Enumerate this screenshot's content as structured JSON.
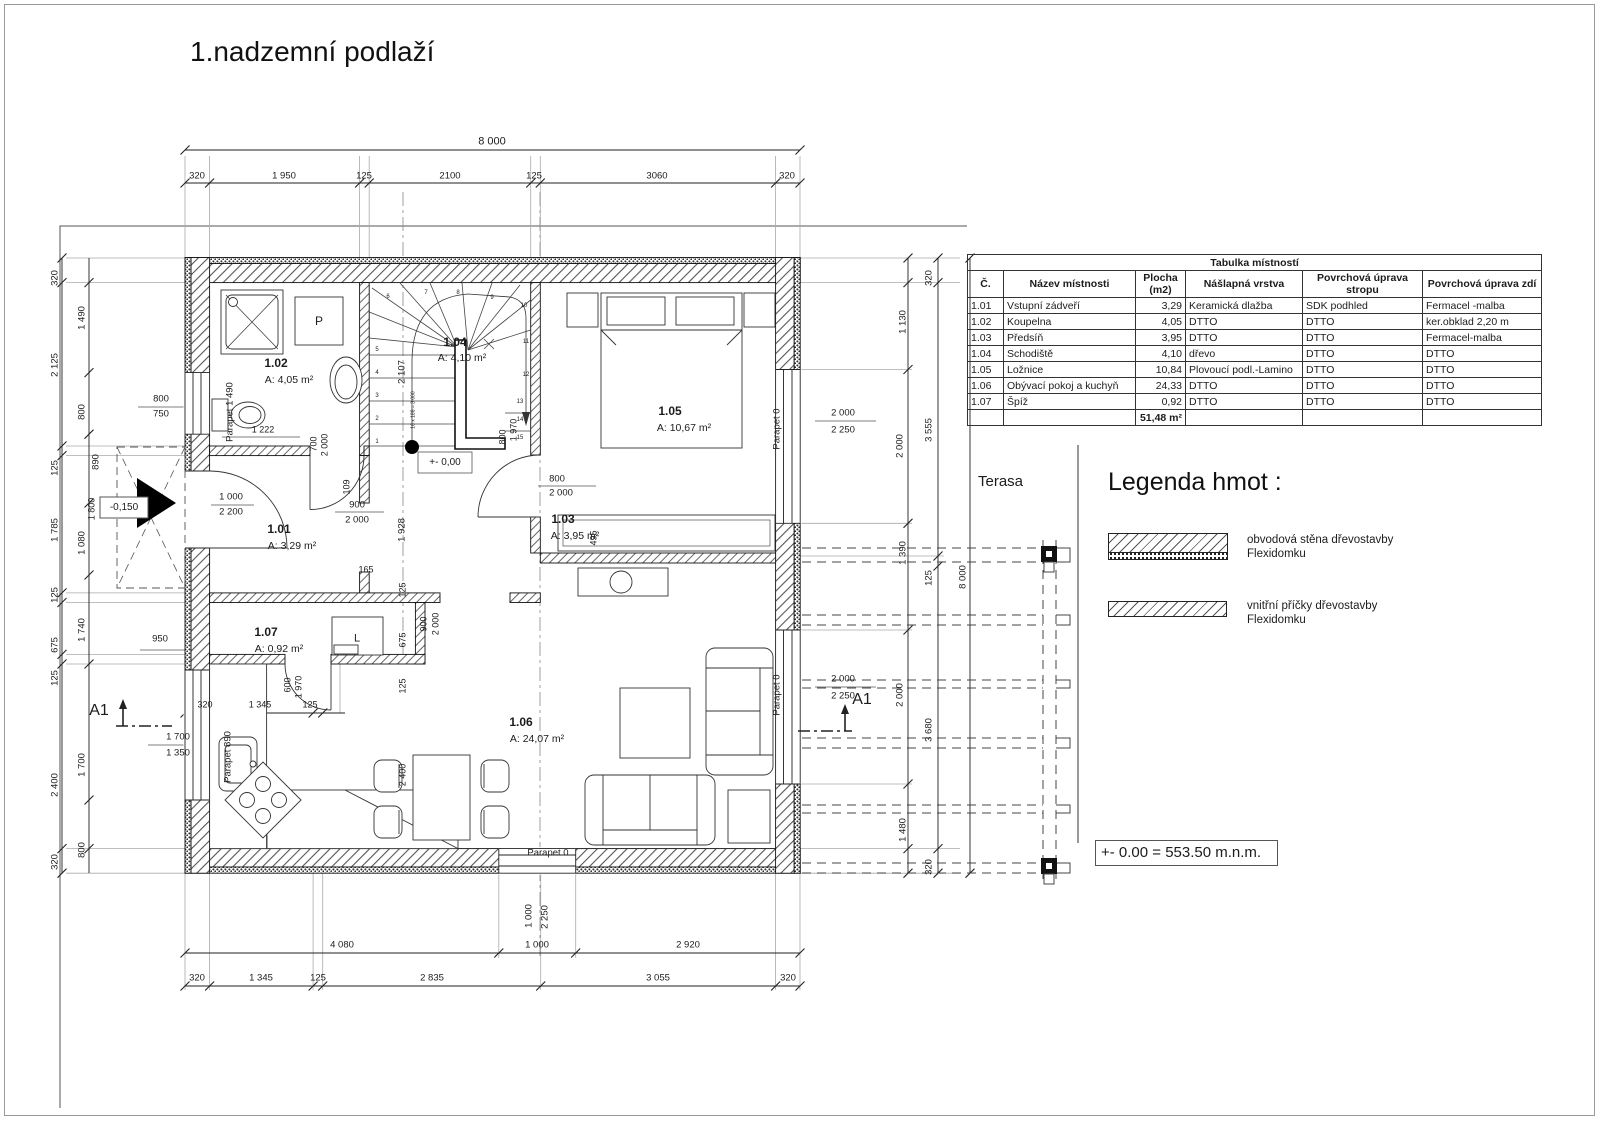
{
  "title": "1.nadzemní podlaží",
  "terrace_label": "Terasa",
  "elevation_note": "+- 0.00 = 553.50 m.n.m.",
  "legend": {
    "title": "Legenda hmot :",
    "items": [
      {
        "swatch": "exterior-wall-hatch",
        "label_line1": "obvodová stěna dřevostavby",
        "label_line2": "Flexidomku"
      },
      {
        "swatch": "interior-partition-hatch",
        "label_line1": "vnitřní příčky dřevostavby",
        "label_line2": "Flexidomku"
      }
    ]
  },
  "room_table": {
    "title": "Tabulka místností",
    "headers": [
      "Č.",
      "Název místnosti",
      "Plocha (m2)",
      "Nášlapná vrstva",
      "Povrchová úprava stropu",
      "Povrchová úprava zdí"
    ],
    "rows": [
      [
        "1.01",
        "Vstupní zádveří",
        "3,29",
        "Keramická dlažba",
        "SDK podhled",
        "Fermacel -malba"
      ],
      [
        "1.02",
        "Koupelna",
        "4,05",
        "DTTO",
        "DTTO",
        "ker.obklad 2,20 m"
      ],
      [
        "1.03",
        "Předsíň",
        "3,95",
        "DTTO",
        "DTTO",
        "Fermacel-malba"
      ],
      [
        "1.04",
        "Schodiště",
        "4,10",
        "dřevo",
        "DTTO",
        "DTTO"
      ],
      [
        "1.05",
        "Ložnice",
        "10,84",
        "Plovoucí podl.-Lamino",
        "DTTO",
        "DTTO"
      ],
      [
        "1.06",
        "Obývací pokoj  a kuchyň",
        "24,33",
        "DTTO",
        "DTTO",
        "DTTO"
      ],
      [
        "1.07",
        "Špíž",
        "0,92",
        "DTTO",
        "DTTO",
        "DTTO"
      ]
    ],
    "total": "51,48 m²"
  },
  "labels": [
    {
      "t": "8 000",
      "x": 492,
      "y": 142,
      "s": 11
    },
    {
      "t": "320",
      "x": 197,
      "y": 176
    },
    {
      "t": "1 950",
      "x": 284,
      "y": 176
    },
    {
      "t": "125",
      "x": 364,
      "y": 176
    },
    {
      "t": "2100",
      "x": 450,
      "y": 176
    },
    {
      "t": "125",
      "x": 534,
      "y": 176
    },
    {
      "t": "3060",
      "x": 657,
      "y": 176
    },
    {
      "t": "320",
      "x": 787,
      "y": 176
    },
    {
      "t": "320",
      "x": 55,
      "y": 278,
      "r": -90
    },
    {
      "t": "2 125",
      "x": 55,
      "y": 365,
      "r": -90
    },
    {
      "t": "125",
      "x": 55,
      "y": 468,
      "r": -90
    },
    {
      "t": "1 785",
      "x": 55,
      "y": 530,
      "r": -90
    },
    {
      "t": "125",
      "x": 55,
      "y": 595,
      "r": -90
    },
    {
      "t": "675",
      "x": 55,
      "y": 645,
      "r": -90
    },
    {
      "t": "125",
      "x": 55,
      "y": 678,
      "r": -90
    },
    {
      "t": "2 400",
      "x": 55,
      "y": 785,
      "r": -90
    },
    {
      "t": "320",
      "x": 55,
      "y": 862,
      "r": -90
    },
    {
      "t": "1 490",
      "x": 82,
      "y": 318,
      "r": -90
    },
    {
      "t": "800",
      "x": 82,
      "y": 412,
      "r": -90
    },
    {
      "t": "890",
      "x": 96,
      "y": 462,
      "r": -90
    },
    {
      "t": "1 080",
      "x": 82,
      "y": 543,
      "r": -90
    },
    {
      "t": "1 740",
      "x": 82,
      "y": 630,
      "r": -90
    },
    {
      "t": "1 700",
      "x": 82,
      "y": 765,
      "r": -90
    },
    {
      "t": "800",
      "x": 82,
      "y": 850,
      "r": -90
    },
    {
      "t": "800",
      "x": 161,
      "y": 399
    },
    {
      "t": "750",
      "x": 161,
      "y": 414
    },
    {
      "t": "950",
      "x": 160,
      "y": 639
    },
    {
      "t": "-0,150",
      "x": 124,
      "y": 508,
      "s": 10
    },
    {
      "t": "1 800",
      "x": 92,
      "y": 509,
      "r": -90,
      "s": 9
    },
    {
      "t": "1 700",
      "x": 178,
      "y": 737
    },
    {
      "t": "1 350",
      "x": 178,
      "y": 753
    },
    {
      "t": "A1",
      "x": 99,
      "y": 711,
      "s": 16
    },
    {
      "t": "A1",
      "x": 862,
      "y": 700,
      "s": 16
    },
    {
      "t": "1 000",
      "x": 231,
      "y": 497
    },
    {
      "t": "2 200",
      "x": 231,
      "y": 512
    },
    {
      "t": "Parapet 1 490",
      "x": 230,
      "y": 412,
      "r": -90
    },
    {
      "t": "1.02",
      "x": 276,
      "y": 363,
      "b": 1,
      "s": 12
    },
    {
      "t": "A: 4,05 m²",
      "x": 289,
      "y": 380,
      "s": 10.5
    },
    {
      "t": "P",
      "x": 319,
      "y": 321,
      "s": 12
    },
    {
      "t": "1 222",
      "x": 263,
      "y": 430,
      "s": 9
    },
    {
      "t": "700",
      "x": 314,
      "y": 444,
      "r": -90,
      "s": 9
    },
    {
      "t": "2 000",
      "x": 325,
      "y": 445,
      "r": -90,
      "s": 9
    },
    {
      "t": "109",
      "x": 347,
      "y": 487,
      "r": -90,
      "s": 9
    },
    {
      "t": "1.01",
      "x": 279,
      "y": 529,
      "b": 1,
      "s": 12
    },
    {
      "t": "A: 3,29 m²",
      "x": 292,
      "y": 546,
      "s": 10.5
    },
    {
      "t": "900",
      "x": 357,
      "y": 505
    },
    {
      "t": "2 000",
      "x": 357,
      "y": 520
    },
    {
      "t": "1.04",
      "x": 455,
      "y": 342,
      "b": 1,
      "s": 12
    },
    {
      "t": "A: 4,10 m²",
      "x": 462,
      "y": 358,
      "s": 10.5
    },
    {
      "t": "2 107",
      "x": 402,
      "y": 372,
      "r": -90
    },
    {
      "t": "1 928",
      "x": 402,
      "y": 530,
      "r": -90
    },
    {
      "t": "16 x 188 = 3 000",
      "x": 414,
      "y": 410,
      "r": -90,
      "s": 5
    },
    {
      "t": "+- 0,00",
      "x": 445,
      "y": 463,
      "s": 10
    },
    {
      "t": "1",
      "x": 377,
      "y": 442,
      "s": 6
    },
    {
      "t": "2",
      "x": 377,
      "y": 419,
      "s": 6
    },
    {
      "t": "3",
      "x": 377,
      "y": 396,
      "s": 6
    },
    {
      "t": "4",
      "x": 377,
      "y": 373,
      "s": 6
    },
    {
      "t": "5",
      "x": 377,
      "y": 350,
      "s": 6
    },
    {
      "t": "6",
      "x": 388,
      "y": 297,
      "s": 6
    },
    {
      "t": "7",
      "x": 426,
      "y": 293,
      "s": 6
    },
    {
      "t": "8",
      "x": 458,
      "y": 293,
      "s": 6
    },
    {
      "t": "9",
      "x": 492,
      "y": 298,
      "s": 6
    },
    {
      "t": "10",
      "x": 524,
      "y": 306,
      "s": 6
    },
    {
      "t": "11",
      "x": 526,
      "y": 342,
      "s": 6
    },
    {
      "t": "12",
      "x": 526,
      "y": 375,
      "s": 6
    },
    {
      "t": "13",
      "x": 520,
      "y": 402,
      "s": 6
    },
    {
      "t": "14",
      "x": 520,
      "y": 420,
      "s": 6
    },
    {
      "t": "15",
      "x": 520,
      "y": 438,
      "s": 6
    },
    {
      "t": "800",
      "x": 503,
      "y": 437,
      "r": -90,
      "s": 9
    },
    {
      "t": "1 970",
      "x": 514,
      "y": 430,
      "r": -90,
      "s": 9
    },
    {
      "t": "1.03",
      "x": 563,
      "y": 519,
      "b": 1,
      "s": 12
    },
    {
      "t": "A: 3,95 m²",
      "x": 575,
      "y": 536,
      "s": 10.5
    },
    {
      "t": "800",
      "x": 557,
      "y": 479
    },
    {
      "t": "2 000",
      "x": 561,
      "y": 493
    },
    {
      "t": "1.05",
      "x": 670,
      "y": 411,
      "b": 1,
      "s": 12
    },
    {
      "t": "A: 10,67 m²",
      "x": 684,
      "y": 428,
      "s": 10.5
    },
    {
      "t": "Parapet 0",
      "x": 777,
      "y": 429,
      "r": -90
    },
    {
      "t": "495",
      "x": 594,
      "y": 538,
      "r": -90,
      "s": 9
    },
    {
      "t": "1.07",
      "x": 266,
      "y": 632,
      "b": 1,
      "s": 12
    },
    {
      "t": "A: 0,92 m²",
      "x": 279,
      "y": 649,
      "s": 10.5
    },
    {
      "t": "L",
      "x": 357,
      "y": 639,
      "s": 11
    },
    {
      "t": "165",
      "x": 366,
      "y": 570,
      "s": 9
    },
    {
      "t": "125",
      "x": 403,
      "y": 590,
      "r": -90,
      "s": 9
    },
    {
      "t": "675",
      "x": 403,
      "y": 640,
      "r": -90,
      "s": 9
    },
    {
      "t": "125",
      "x": 403,
      "y": 686,
      "r": -90,
      "s": 9
    },
    {
      "t": "900",
      "x": 424,
      "y": 624,
      "r": -90,
      "s": 9
    },
    {
      "t": "2 000",
      "x": 436,
      "y": 624,
      "r": -90,
      "s": 9
    },
    {
      "t": "600",
      "x": 288,
      "y": 685,
      "r": -90,
      "s": 9
    },
    {
      "t": "1 970",
      "x": 299,
      "y": 687,
      "r": -90,
      "s": 9
    },
    {
      "t": "320",
      "x": 205,
      "y": 705,
      "s": 9
    },
    {
      "t": "1 345",
      "x": 260,
      "y": 705,
      "s": 9
    },
    {
      "t": "125",
      "x": 310,
      "y": 705,
      "s": 9
    },
    {
      "t": "Parapet 890",
      "x": 228,
      "y": 757,
      "r": -90
    },
    {
      "t": "2 400",
      "x": 403,
      "y": 775,
      "r": -90,
      "s": 9
    },
    {
      "t": "1.06",
      "x": 521,
      "y": 722,
      "b": 1,
      "s": 12
    },
    {
      "t": "A: 24,07 m²",
      "x": 537,
      "y": 739,
      "s": 10.5
    },
    {
      "t": "Parapet 0",
      "x": 548,
      "y": 853
    },
    {
      "t": "Parapet 0",
      "x": 777,
      "y": 695,
      "r": -90
    },
    {
      "t": "2 000",
      "x": 843,
      "y": 413
    },
    {
      "t": "2 250",
      "x": 843,
      "y": 430
    },
    {
      "t": "2 000",
      "x": 843,
      "y": 679
    },
    {
      "t": "2 250",
      "x": 843,
      "y": 696
    },
    {
      "t": "320",
      "x": 929,
      "y": 278,
      "r": -90
    },
    {
      "t": "1 130",
      "x": 903,
      "y": 322,
      "r": -90
    },
    {
      "t": "2 000",
      "x": 900,
      "y": 446,
      "r": -90
    },
    {
      "t": "3 555",
      "x": 929,
      "y": 430,
      "r": -90
    },
    {
      "t": "1 390",
      "x": 903,
      "y": 553,
      "r": -90
    },
    {
      "t": "125",
      "x": 929,
      "y": 578,
      "r": -90
    },
    {
      "t": "2 000",
      "x": 900,
      "y": 695,
      "r": -90
    },
    {
      "t": "3 680",
      "x": 929,
      "y": 730,
      "r": -90
    },
    {
      "t": "1 480",
      "x": 903,
      "y": 830,
      "r": -90
    },
    {
      "t": "320",
      "x": 929,
      "y": 867,
      "r": -90
    },
    {
      "t": "8 000",
      "x": 963,
      "y": 577,
      "r": -90
    },
    {
      "t": "1 000",
      "x": 529,
      "y": 916,
      "r": -90
    },
    {
      "t": "2 250",
      "x": 545,
      "y": 917,
      "r": -90
    },
    {
      "t": "4 080",
      "x": 342,
      "y": 945
    },
    {
      "t": "1 000",
      "x": 537,
      "y": 945
    },
    {
      "t": "2 920",
      "x": 688,
      "y": 945
    },
    {
      "t": "320",
      "x": 197,
      "y": 978
    },
    {
      "t": "1 345",
      "x": 261,
      "y": 978
    },
    {
      "t": "125",
      "x": 318,
      "y": 978
    },
    {
      "t": "2 835",
      "x": 432,
      "y": 978
    },
    {
      "t": "3 055",
      "x": 658,
      "y": 978
    },
    {
      "t": "320",
      "x": 788,
      "y": 978
    }
  ]
}
